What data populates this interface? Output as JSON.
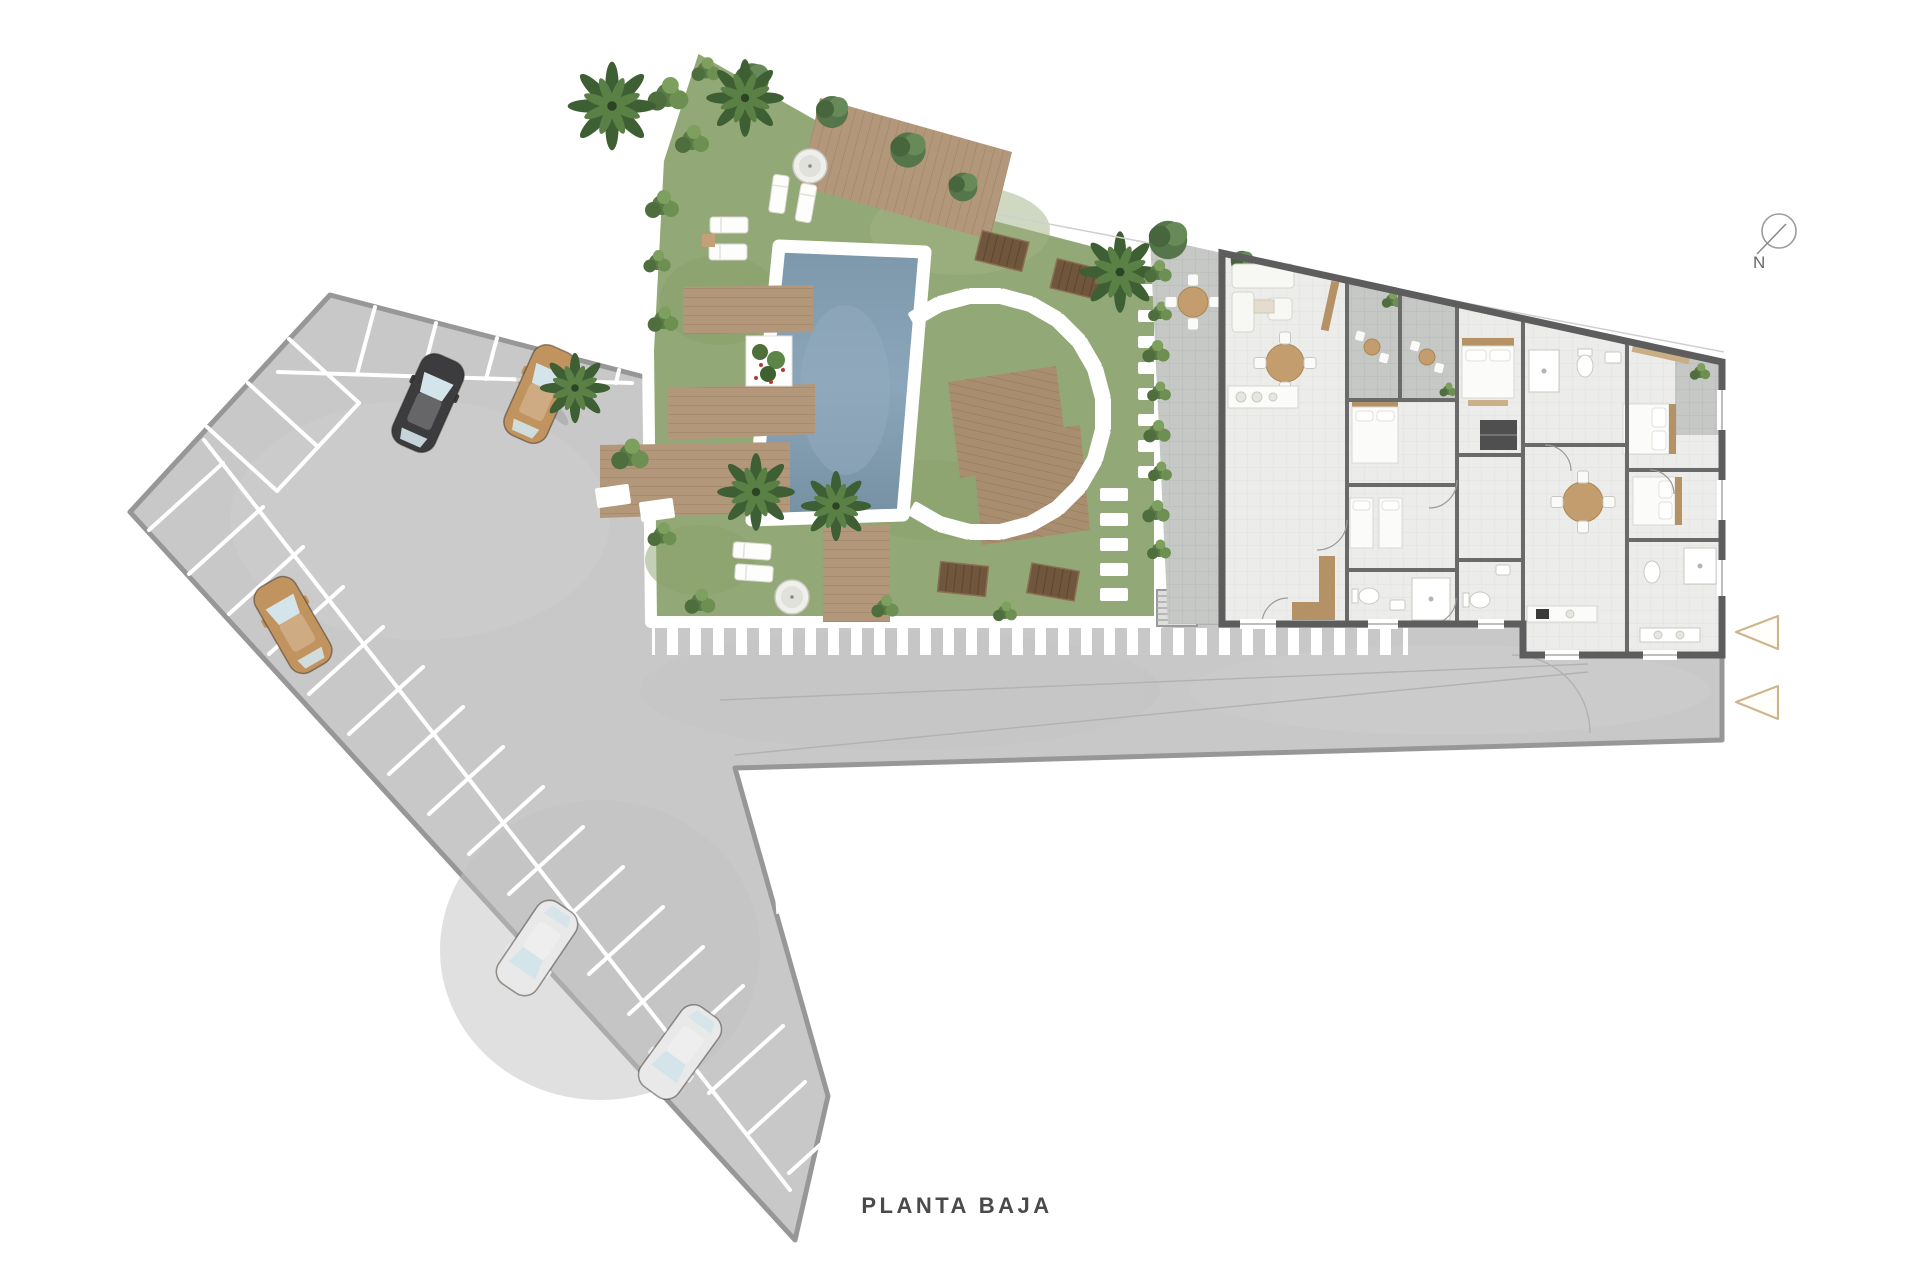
{
  "title": {
    "text": "PLANTA BAJA"
  },
  "compass": {
    "label": "N"
  },
  "plan": {
    "type": "architectural-site-plan-ground-floor",
    "areas": {
      "parking": {
        "surface": "asphalt",
        "stall_rows": 3,
        "cars": [
          {
            "id": "car-dark",
            "color_hex": "#3c3c3e",
            "location": "top-row"
          },
          {
            "id": "car-tan-top",
            "color_hex": "#c1945f",
            "location": "top-row"
          },
          {
            "id": "car-tan-left",
            "color_hex": "#c1945f",
            "location": "left-row"
          },
          {
            "id": "car-silver-1",
            "color_hex": "#e9e9e9",
            "location": "left-row"
          },
          {
            "id": "car-silver-2",
            "color_hex": "#e9e9e9",
            "location": "left-row"
          }
        ]
      },
      "garden": {
        "features": [
          "swimming-pool",
          "wood-decks",
          "palm-trees",
          "sun-loungers",
          "stepping-stone-arc",
          "picnic-tables",
          "planter",
          "hedge",
          "parasols",
          "stairs"
        ]
      },
      "building": {
        "rooms": [
          "living-room",
          "kitchen",
          "bedrooms",
          "bathrooms",
          "terraces",
          "patio",
          "corridor"
        ]
      },
      "crosswalk": {
        "stripes": true
      },
      "entrance_markers": {
        "count": 2,
        "shape": "triangle-left",
        "outline_hex": "#cdb68b"
      }
    }
  },
  "palette": {
    "asphalt": "#c8c8c8",
    "grass": "#93a877",
    "wood": "#b2977a",
    "water": "#7f9aae",
    "floor": "#ecedeb",
    "terrace": "#c6c9c6",
    "wall": "#5d5d5d",
    "accent_tan": "#cdb68b",
    "text": "#4a4a4a"
  }
}
